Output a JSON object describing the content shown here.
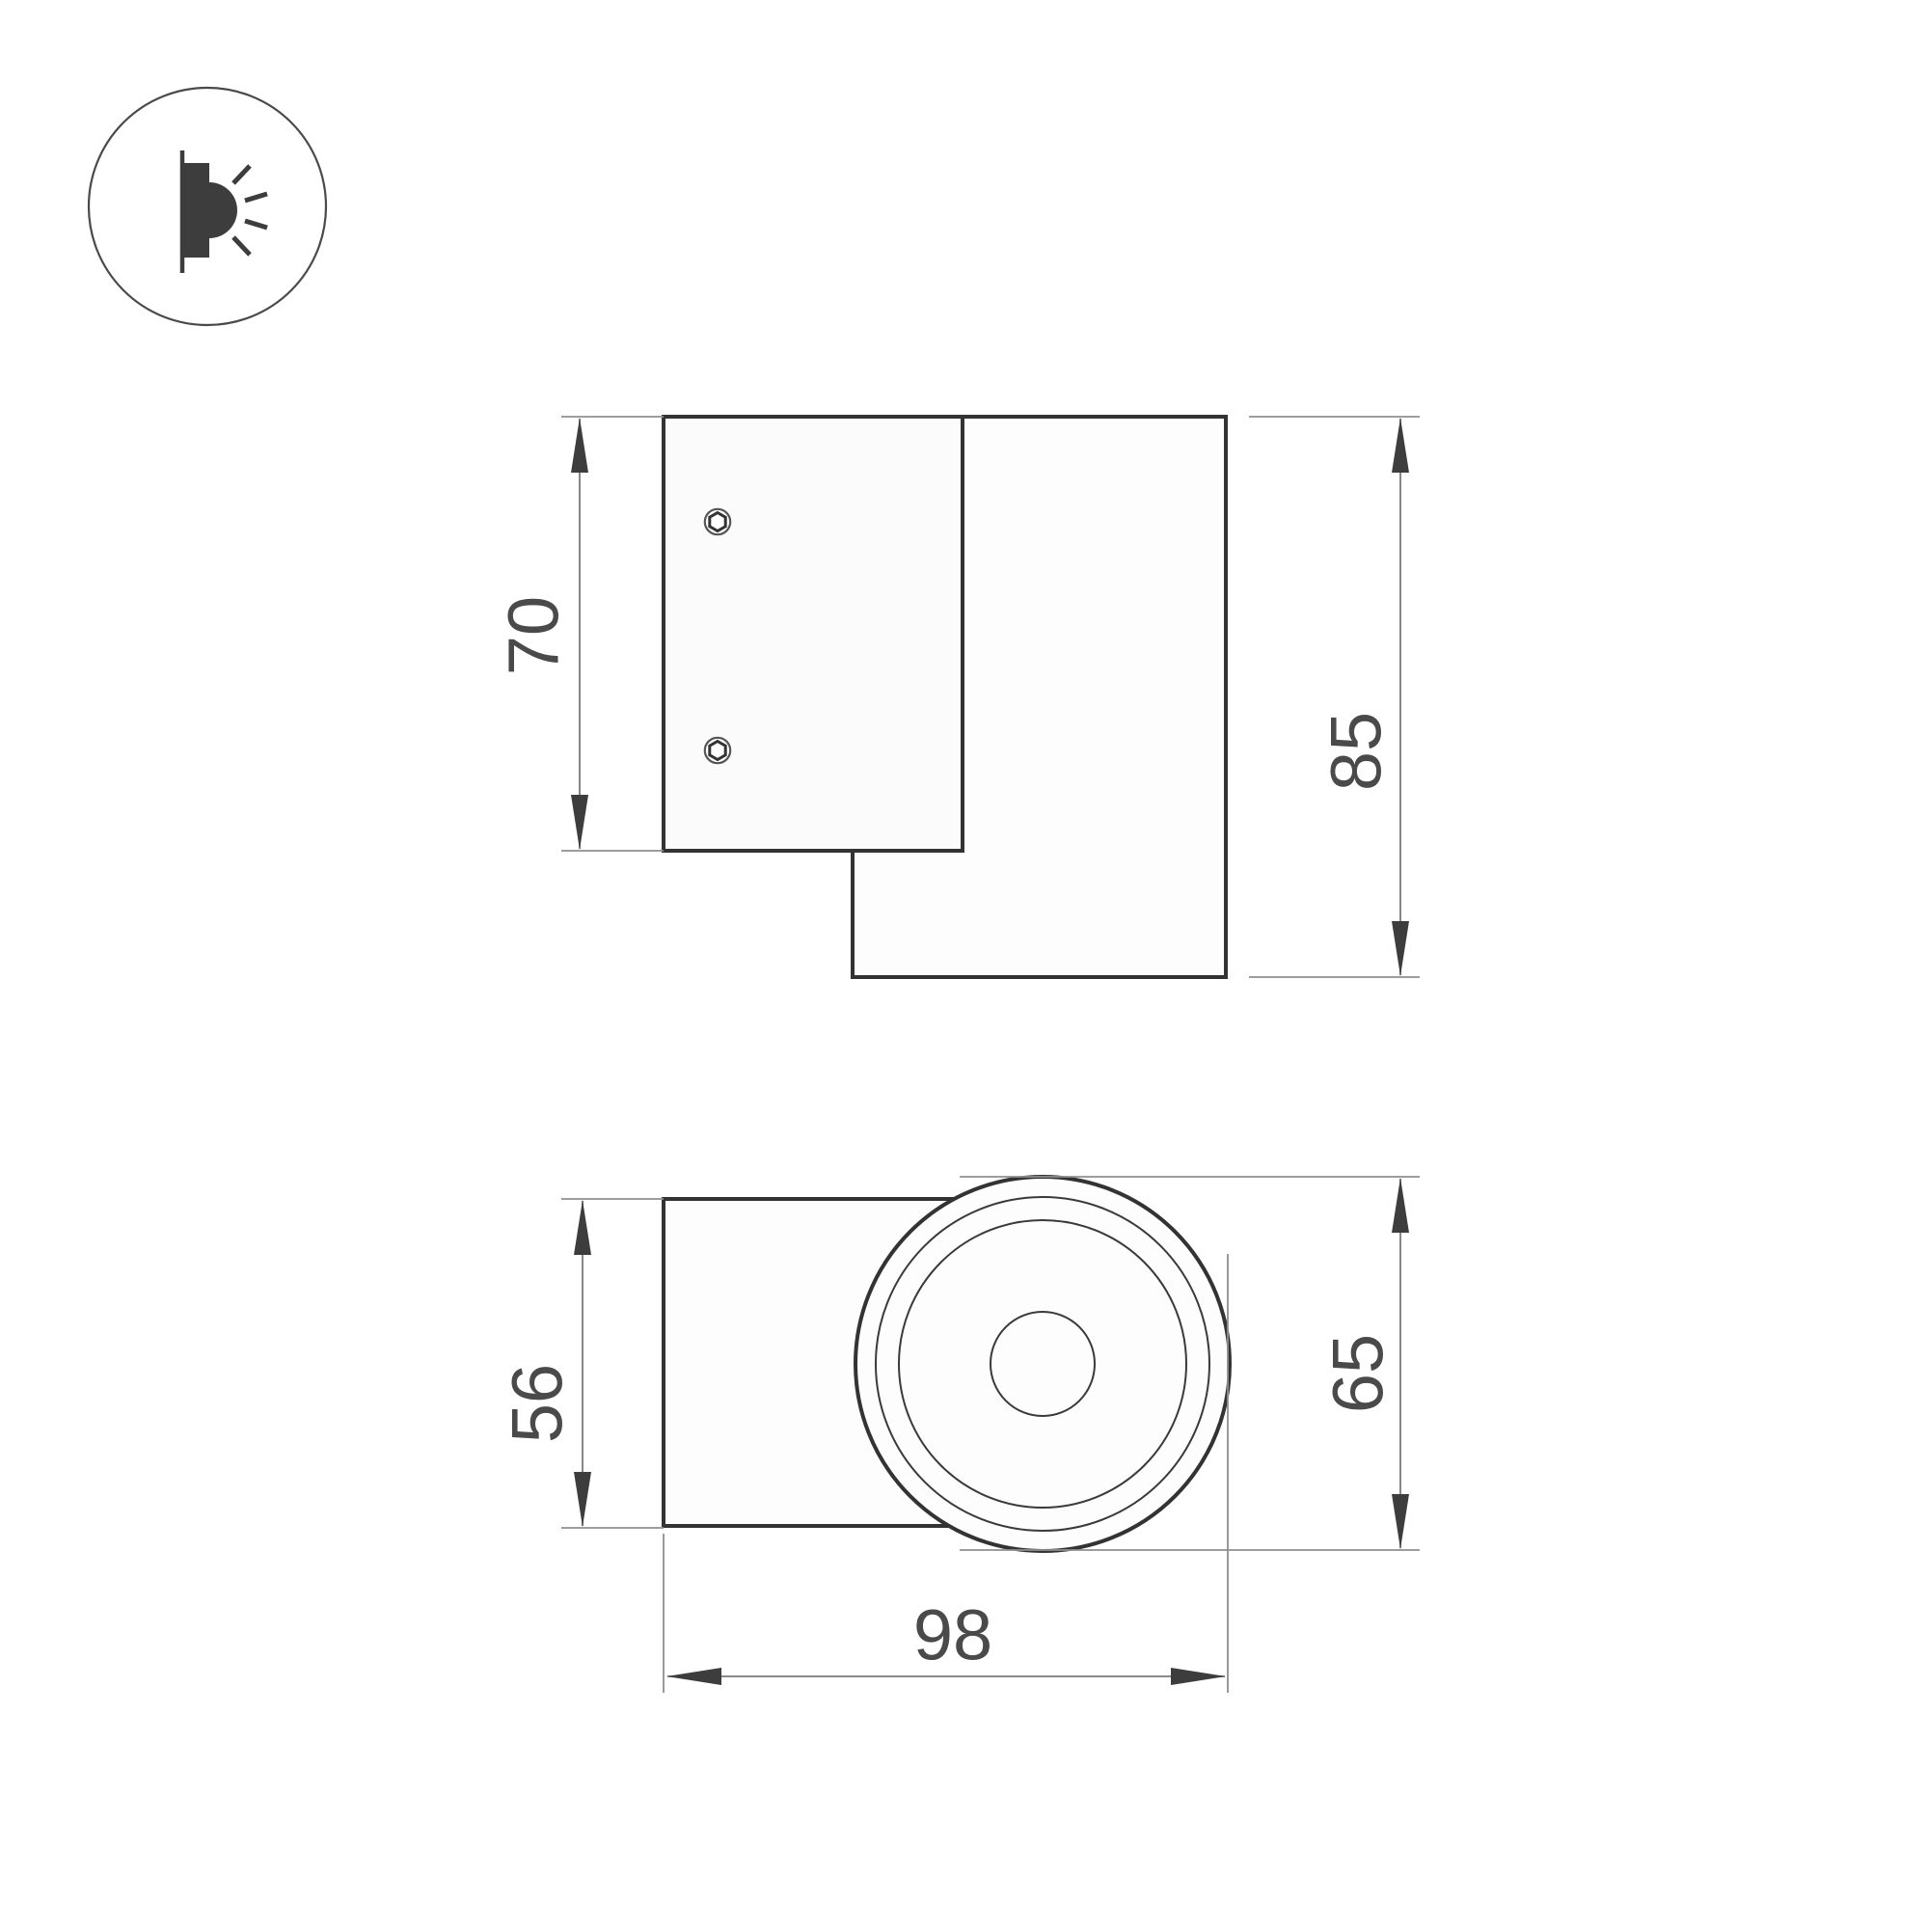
{
  "colors": {
    "background": "#ffffff",
    "outline": "#333333",
    "dimension_text": "#4a4a4a",
    "thin_line": "#8f8f8f",
    "arrow": "#3d3d3d"
  },
  "icon": {
    "glyph": "wall-mounted-light-side-glow"
  },
  "side_view": {
    "plate_height_mm": "70",
    "overall_height_mm": "85"
  },
  "front_view": {
    "body_width_mm": "56",
    "face_diameter_mm": "65",
    "overall_depth_mm": "98"
  }
}
